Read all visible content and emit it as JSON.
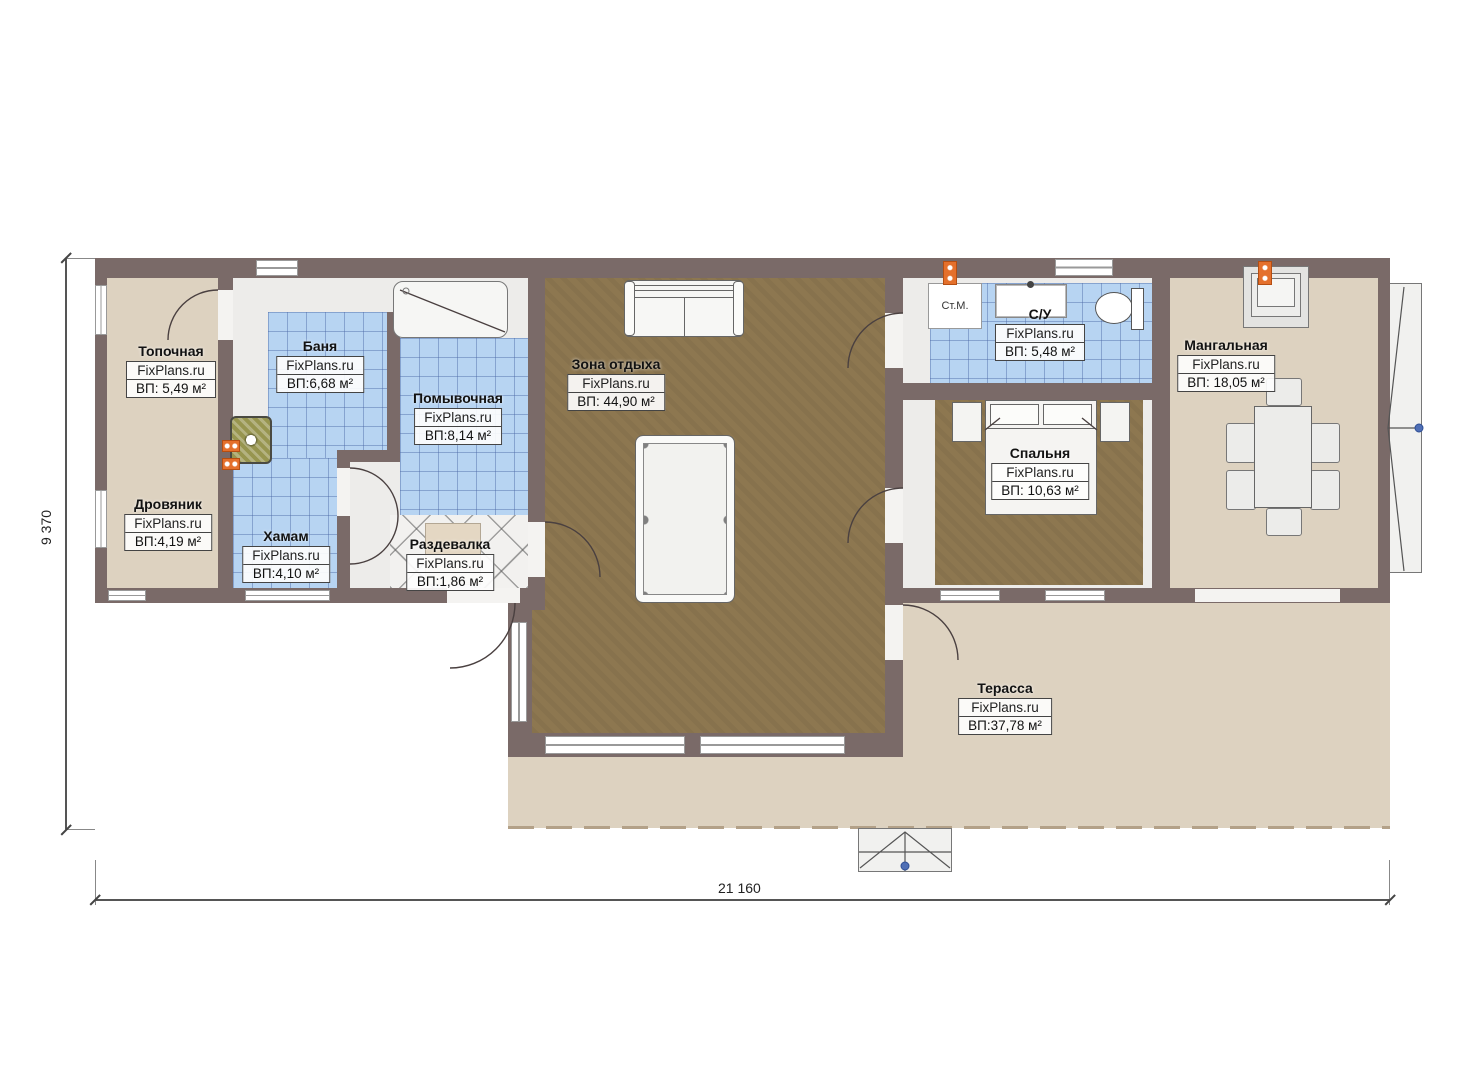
{
  "plan": {
    "watermark": "FixPlans.ru",
    "dim_width": "21 160",
    "dim_height": "9 370",
    "appliance": "Ст.М.",
    "rooms": [
      {
        "name": "Топочная",
        "area": "ВП: 5,49 м²"
      },
      {
        "name": "Дровяник",
        "area": "ВП:4,19 м²"
      },
      {
        "name": "Баня",
        "area": "ВП:6,68 м²"
      },
      {
        "name": "Помывочная",
        "area": "ВП:8,14 м²"
      },
      {
        "name": "Хамам",
        "area": "ВП:4,10 м²"
      },
      {
        "name": "Раздевалка",
        "area": "ВП:1,86 м²"
      },
      {
        "name": "Зона отдыха",
        "area": "ВП: 44,90 м²"
      },
      {
        "name": "С/У",
        "area": "ВП: 5,48 м²"
      },
      {
        "name": "Спальня",
        "area": "ВП: 10,63 м²"
      },
      {
        "name": "Мангальная",
        "area": "ВП: 18,05 м²"
      },
      {
        "name": "Терасса",
        "area": "ВП:37,78 м²"
      }
    ],
    "colors": {
      "wall": "#7a6a68",
      "tile_blue": "#b7d4f2",
      "wood_floor": "#8d7750",
      "beige_floor": "#ddd2c0",
      "marker_orange": "#e4702c",
      "step_dot_blue": "#4f6fb5"
    }
  }
}
